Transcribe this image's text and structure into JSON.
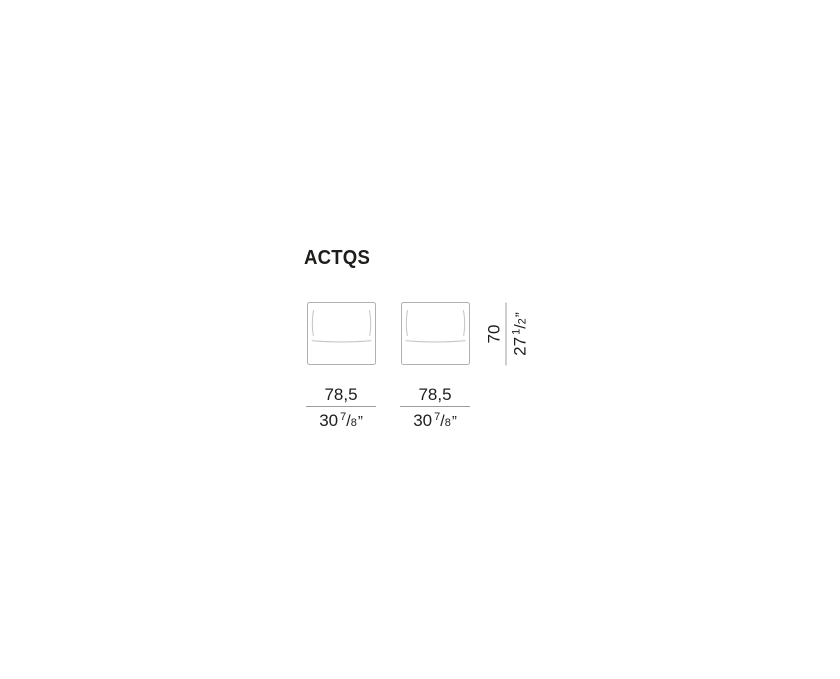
{
  "title": "ACTQS",
  "colors": {
    "background": "#ffffff",
    "text": "#1d1d1b",
    "frame-stroke": "#b1b1b1",
    "cushion-stroke": "#c4c4c4",
    "dim-line": "#9c9c9c"
  },
  "symbols": {
    "fraction_slash": "/"
  },
  "drawing": {
    "view": "front",
    "module_count": 2
  },
  "modules": [
    {
      "width": {
        "metric": "78,5",
        "imperial_whole": "30",
        "imperial_num": "7",
        "imperial_den": "8",
        "imperial_unit": "”"
      }
    },
    {
      "width": {
        "metric": "78,5",
        "imperial_whole": "30",
        "imperial_num": "7",
        "imperial_den": "8",
        "imperial_unit": "”"
      }
    }
  ],
  "height": {
    "metric": "70",
    "imperial_whole": "27",
    "imperial_num": "1",
    "imperial_den": "2",
    "imperial_unit": "”"
  }
}
